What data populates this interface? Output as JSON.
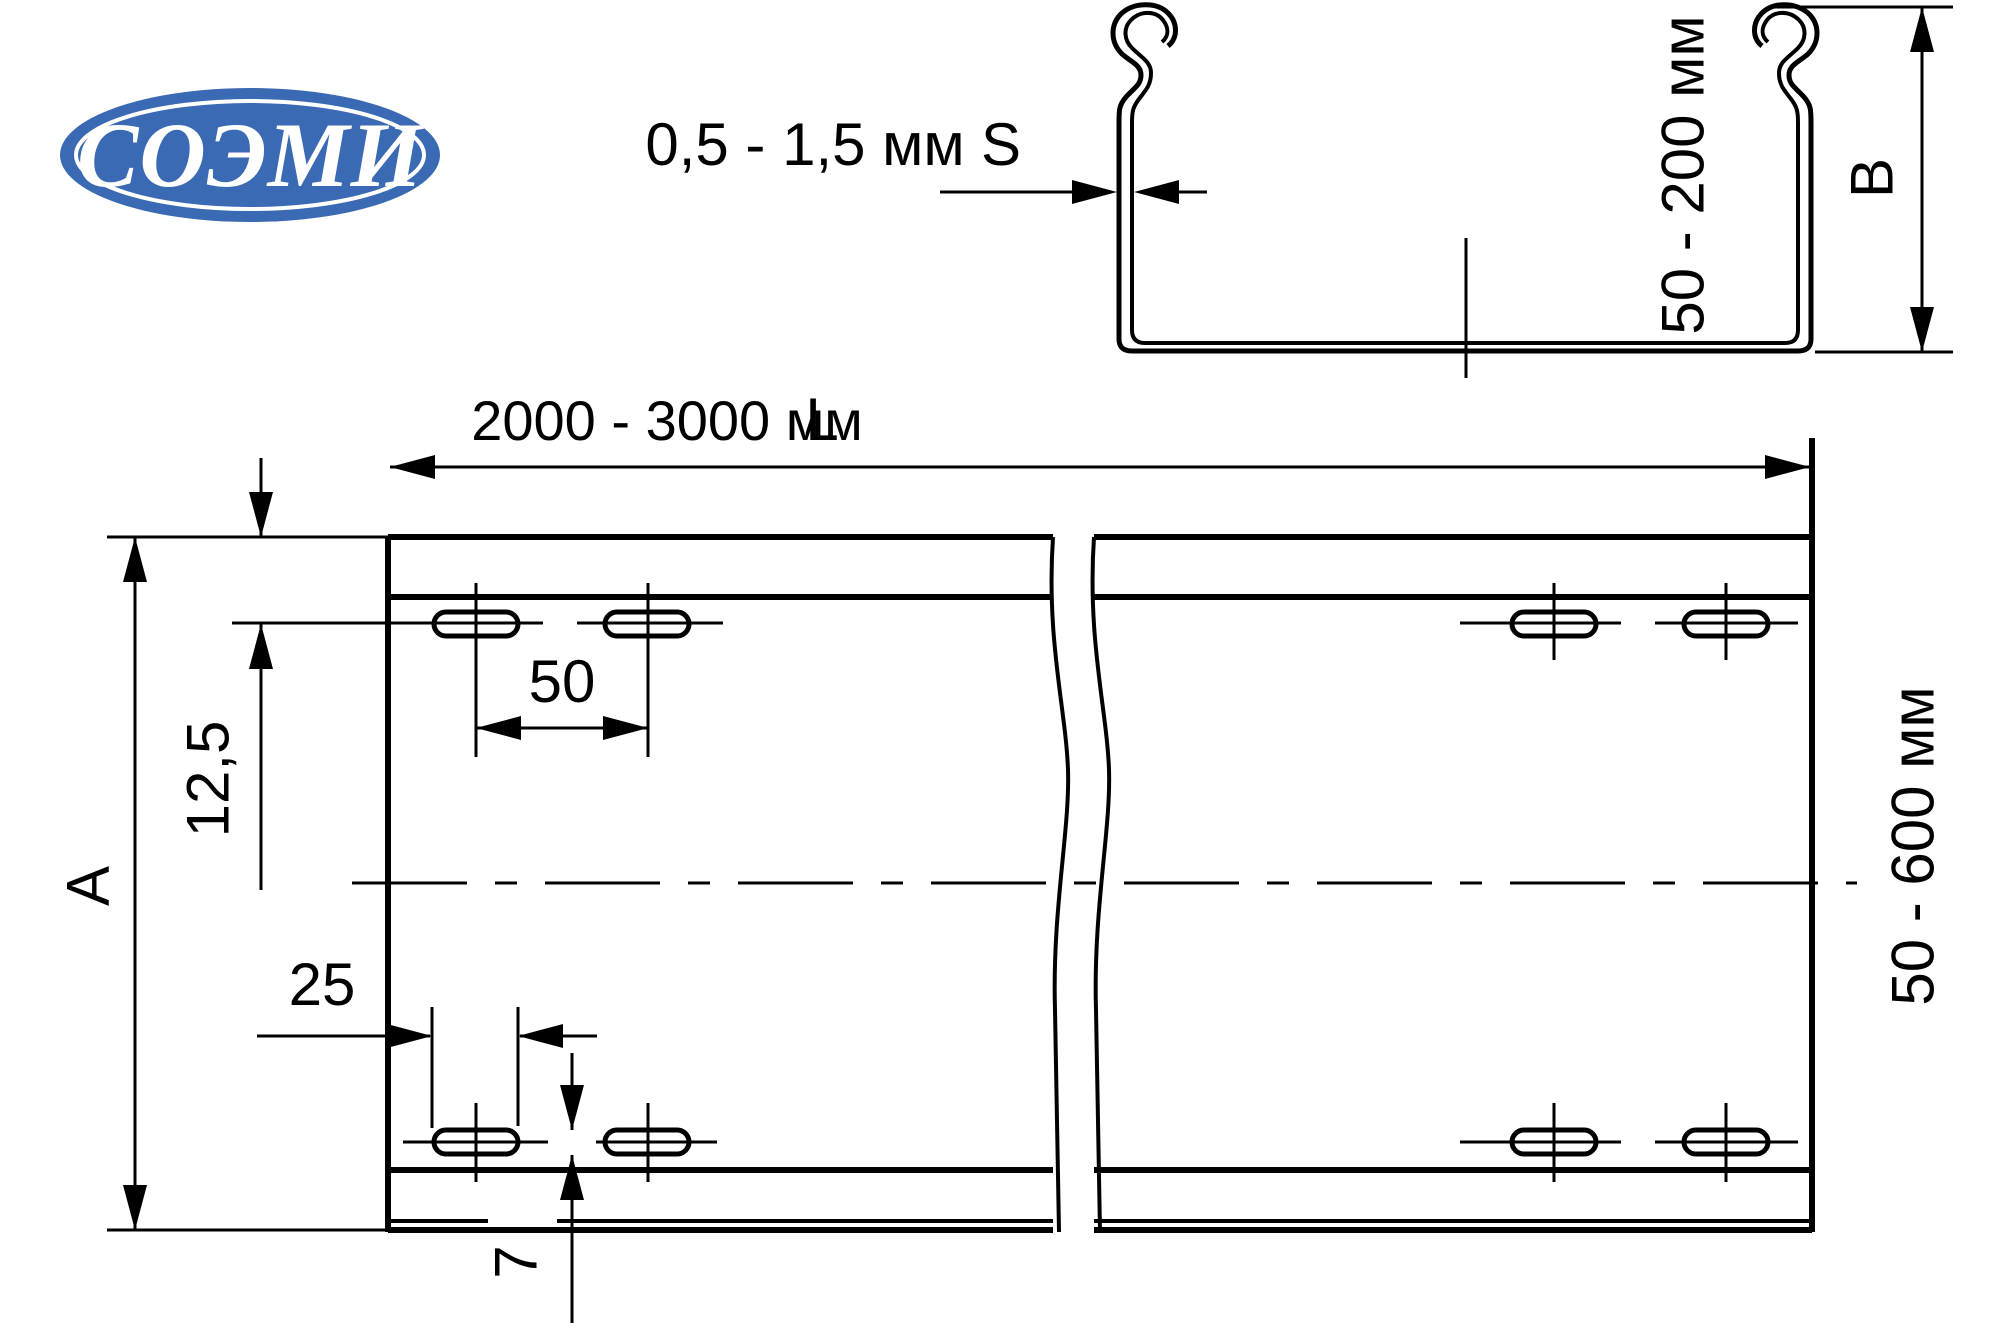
{
  "logo": {
    "text": "СОЭМИ"
  },
  "section_view": {
    "thickness_value": "0,5 - 1,5 мм",
    "thickness_symbol": "S",
    "height_value": "50 - 200 мм",
    "height_symbol": "B"
  },
  "plan_view": {
    "length_value": "2000 - 3000 мм",
    "length_symbol": "L",
    "width_symbol": "A",
    "width_value": "50 - 600 мм",
    "hole_offset_from_edge": "12,5",
    "hole_pitch": "50",
    "hole_length": "25",
    "hole_width": "7"
  },
  "colors": {
    "line": "#000000",
    "logo_blue": "#3b6ab4",
    "background": "#ffffff"
  }
}
